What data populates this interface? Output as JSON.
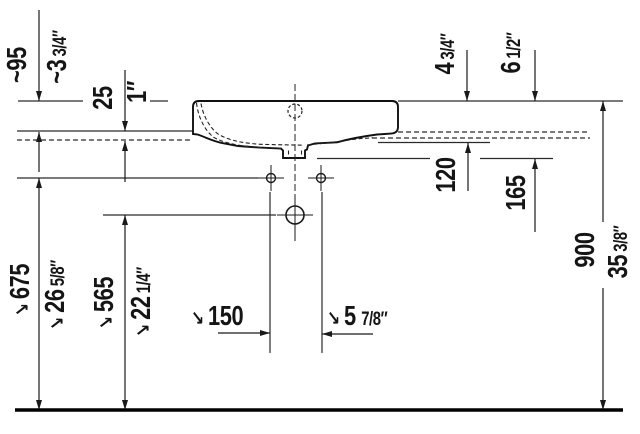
{
  "drawing_title": "washbasin installation dimensions (side section)",
  "colors": {
    "ink": "#1a1a1a",
    "background": "#ffffff"
  },
  "icons": {
    "leader_arrow": "↘"
  },
  "dimensions": {
    "rim_above_console": {
      "metric": "~95",
      "imp_main": "~3",
      "imp_frac": "3/4″"
    },
    "console_thickness": {
      "metric": "25",
      "imp_main": "1″",
      "imp_frac": ""
    },
    "underside_drop": {
      "metric": "120",
      "imp_main": "4",
      "imp_frac": "3/4″"
    },
    "fixing_drop": {
      "metric": "165",
      "imp_main": "6",
      "imp_frac": "1/2″"
    },
    "fixing_holes_height": {
      "metric": "675",
      "imp_main": "26",
      "imp_frac": "5/8″"
    },
    "drain_height": {
      "metric": "565",
      "imp_main": "22",
      "imp_frac": "1/4″"
    },
    "fixing_hole_spacing": {
      "metric": "150",
      "imp_main": "5",
      "imp_frac": "7/8″"
    },
    "rim_height_overall": {
      "metric": "900",
      "imp_main": "35",
      "imp_frac": "3/8″"
    }
  }
}
